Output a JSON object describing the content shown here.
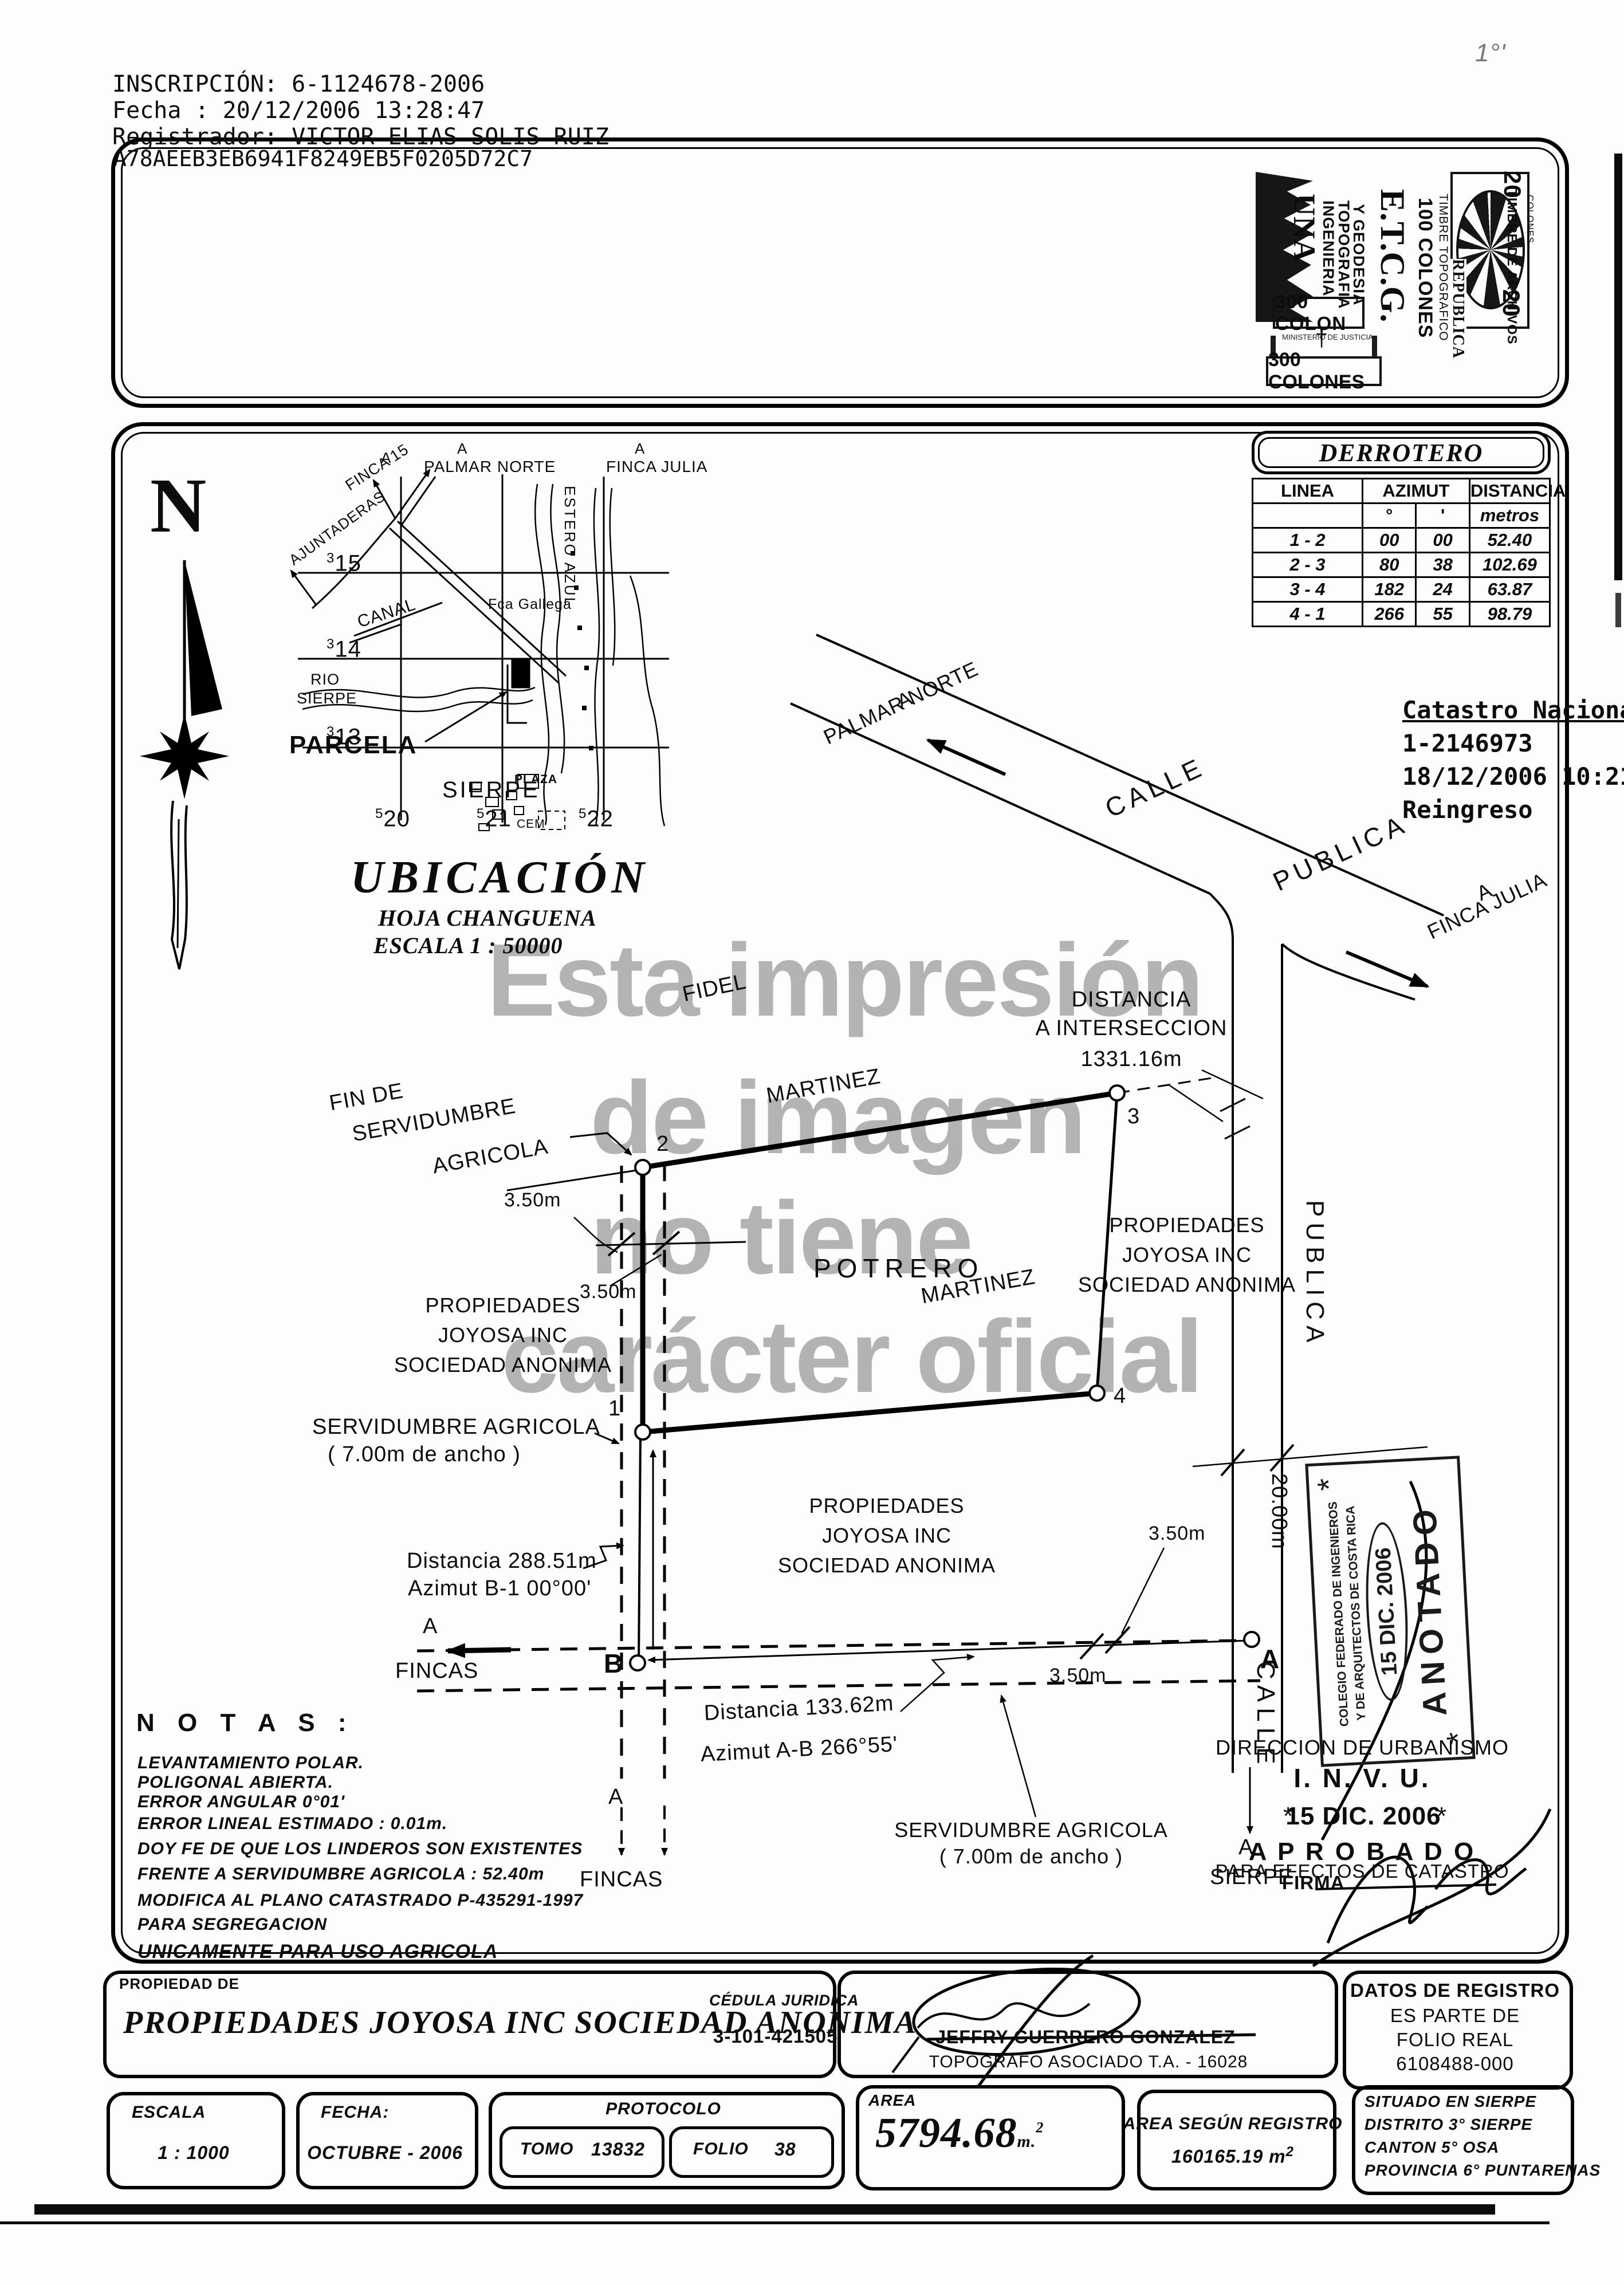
{
  "header": {
    "inscripcion": "INSCRIPCIÓN: 6-1124678-2006",
    "fecha": "Fecha      : 20/12/2006 13:28:47",
    "registrador": "Registrador: VICTOR ELIAS SOLIS RUIZ",
    "hash": "A78AEEB3EB6941F8249EB5F0205D72C7",
    "corner_mark": "1°'"
  },
  "stamps": {
    "una": "UNA",
    "ingenieria": "INGENIERIA",
    "topografia": "TOPOGRAFIA",
    "geodesia": "Y GEODESIA",
    "etcg": "E.T.C.G.",
    "c100a": "100 COLONES",
    "c100b": "TIMBRE TOPOGRAFICO",
    "republica": "REPUBLICA",
    "archivos": "TIMBRE DE ARCHIVOS",
    "veinte": "20",
    "colones": "COLONES",
    "c300a": "300 COLON",
    "ministerio": "MINISTERIO DE JUSTICIA",
    "cruz": "†",
    "c300b": "300 COLONES"
  },
  "derrotero": {
    "title": "DERROTERO",
    "col_linea": "LINEA",
    "col_azimut": "AZIMUT",
    "col_distancia": "DISTANCIA",
    "sub_deg": "°",
    "sub_min": "'",
    "sub_metros": "metros",
    "rows": [
      [
        "1 - 2",
        "00",
        "00",
        "52.40"
      ],
      [
        "2 - 3",
        "80",
        "38",
        "102.69"
      ],
      [
        "3 - 4",
        "182",
        "24",
        "63.87"
      ],
      [
        "4 - 1",
        "266",
        "55",
        "98.79"
      ]
    ]
  },
  "catastro": {
    "l1": "Catastro Nacional",
    "l2": "1-2146973",
    "l3": "18/12/2006 10:21:33",
    "l4": "Reingreso"
  },
  "north": {
    "n": "N"
  },
  "map": {
    "a1": "A",
    "finca15": "FINCA 15",
    "a2": "A",
    "palmar": "PALMAR NORTE",
    "a3": "A",
    "julia": "FINCA JULIA",
    "ajuntaderas": "AJUNTADERAS",
    "estero": "ESTERO AZUL",
    "canal": "CANAL",
    "gallega": "Fca Gallega",
    "rio1": "RIO",
    "rio2": "SIERPE",
    "parcela": "PARCELA",
    "sierpe": "SIERPE",
    "plaza": "PLAZA",
    "cem": "CEM",
    "g15s": "3",
    "g15": "15",
    "g14s": "3",
    "g14": "14",
    "g13s": "3",
    "g13": "13",
    "g20s": "5",
    "g20": "20",
    "g21s": "5",
    "g21": "21",
    "g22s": "5",
    "g22": "22"
  },
  "ubicacion": {
    "title": "UBICACIÓN",
    "hoja": "HOJA  CHANGUENA",
    "escala": "ESCALA 1 : 50000"
  },
  "watermark": {
    "l1": "Esta impresión",
    "l2": "de imagen",
    "l3": "no tiene",
    "l4": "carácter oficial"
  },
  "plan": {
    "a_palmar_a": "A",
    "a_palmar": "PALMAR NORTE",
    "calle": "CALLE",
    "publica": "PUBLICA",
    "a_julia_a": "A",
    "a_julia": "FINCA JULIA",
    "dist1": "DISTANCIA",
    "dist2": "A INTERSECCION",
    "dist3": "1331.16m",
    "fidel": "FIDEL",
    "martinez": "MARTINEZ",
    "fin1": "FIN DE",
    "fin2": "SERVIDUMBRE",
    "fin3": "AGRICOLA",
    "m350": "3.50m",
    "potrero": "POTRERO",
    "owner1": "PROPIEDADES",
    "owner2": "JOYOSA INC",
    "owner3": "SOCIEDAD ANONIMA",
    "serv1": "SERVIDUMBRE AGRICOLA",
    "serv2": "( 7.00m de ancho )",
    "db1a": "Distancia 288.51m",
    "db1b": "Azimut B-1 00°00'",
    "daba": "Distancia 133.62m",
    "dabb": "Azimut A-B 266°55'",
    "a_label": "A",
    "fincas": "FINCAS",
    "w20": "20.00m",
    "calle_v": "CALLE",
    "publica_v": "PUBLICA",
    "p1": "1",
    "p2": "2",
    "p3": "3",
    "p4": "4",
    "pa": "A",
    "pb": "B",
    "sierpe_a": "A",
    "sierpe": "SIERPE"
  },
  "anotado": {
    "org1": "COLEGIO FEDERADO DE INGENIEROS",
    "org2": "Y DE ARQUITECTOS DE COSTA RICA",
    "date": "15 DIC. 2006",
    "word": "ANOTADO",
    "star": "*"
  },
  "invu": {
    "dir": "DIRECCION DE URBANISMO",
    "name": "I. N. V. U.",
    "star": "*",
    "date": "15 DIC. 2006",
    "aprobado": "A P R O B A D O",
    "efectos": "PARA EFECTOS DE CATASTRO",
    "firma": "FIRMA"
  },
  "notas": {
    "title": "N O T A S :",
    "l1": "LEVANTAMIENTO POLAR.",
    "l2": "POLIGONAL ABIERTA.",
    "l3": "ERROR ANGULAR 0°01'",
    "l4": "ERROR LINEAL ESTIMADO : 0.01m.",
    "l5": "DOY FE DE QUE LOS LINDEROS SON EXISTENTES",
    "l6": "FRENTE A SERVIDUMBRE AGRICOLA : 52.40m",
    "l7": "MODIFICA AL PLANO CATASTRADO P-435291-1997",
    "l8": "PARA SEGREGACION",
    "l9": "UNICAMENTE PARA USO AGRICOLA"
  },
  "footer": {
    "propiedad_de": "PROPIEDAD DE",
    "owner": "PROPIEDADES JOYOSA INC SOCIEDAD ANONIMA",
    "cedula_label": "CÉDULA JURIDICA",
    "cedula": "3-101-421505",
    "topografo": "JEFFRY GUERRERO GONZALEZ",
    "topografo_title": "TOPÓGRAFO ASOCIADO T.A. - 16028",
    "datos1": "DATOS DE REGISTRO",
    "datos2": "ES PARTE DE",
    "datos3": "FOLIO REAL",
    "datos4": "6108488-000",
    "escala_label": "ESCALA",
    "escala": "1 : 1000",
    "fecha_label": "FECHA:",
    "fecha": "OCTUBRE - 2006",
    "protocolo": "PROTOCOLO",
    "tomo_label": "TOMO",
    "tomo": "13832",
    "folio_label": "FOLIO",
    "folio": "38",
    "area_label": "AREA",
    "area": "5794.68",
    "area_unit": "m.",
    "area_sup": "2",
    "registro_label": "AREA SEGÚN REGISTRO",
    "registro": "160165.19 m",
    "registro_sup": "2",
    "sit1": "SITUADO EN SIERPE",
    "sit2": "DISTRITO 3° SIERPE",
    "sit3": "CANTON 5° OSA",
    "sit4": "PROVINCIA 6° PUNTARENAS"
  }
}
